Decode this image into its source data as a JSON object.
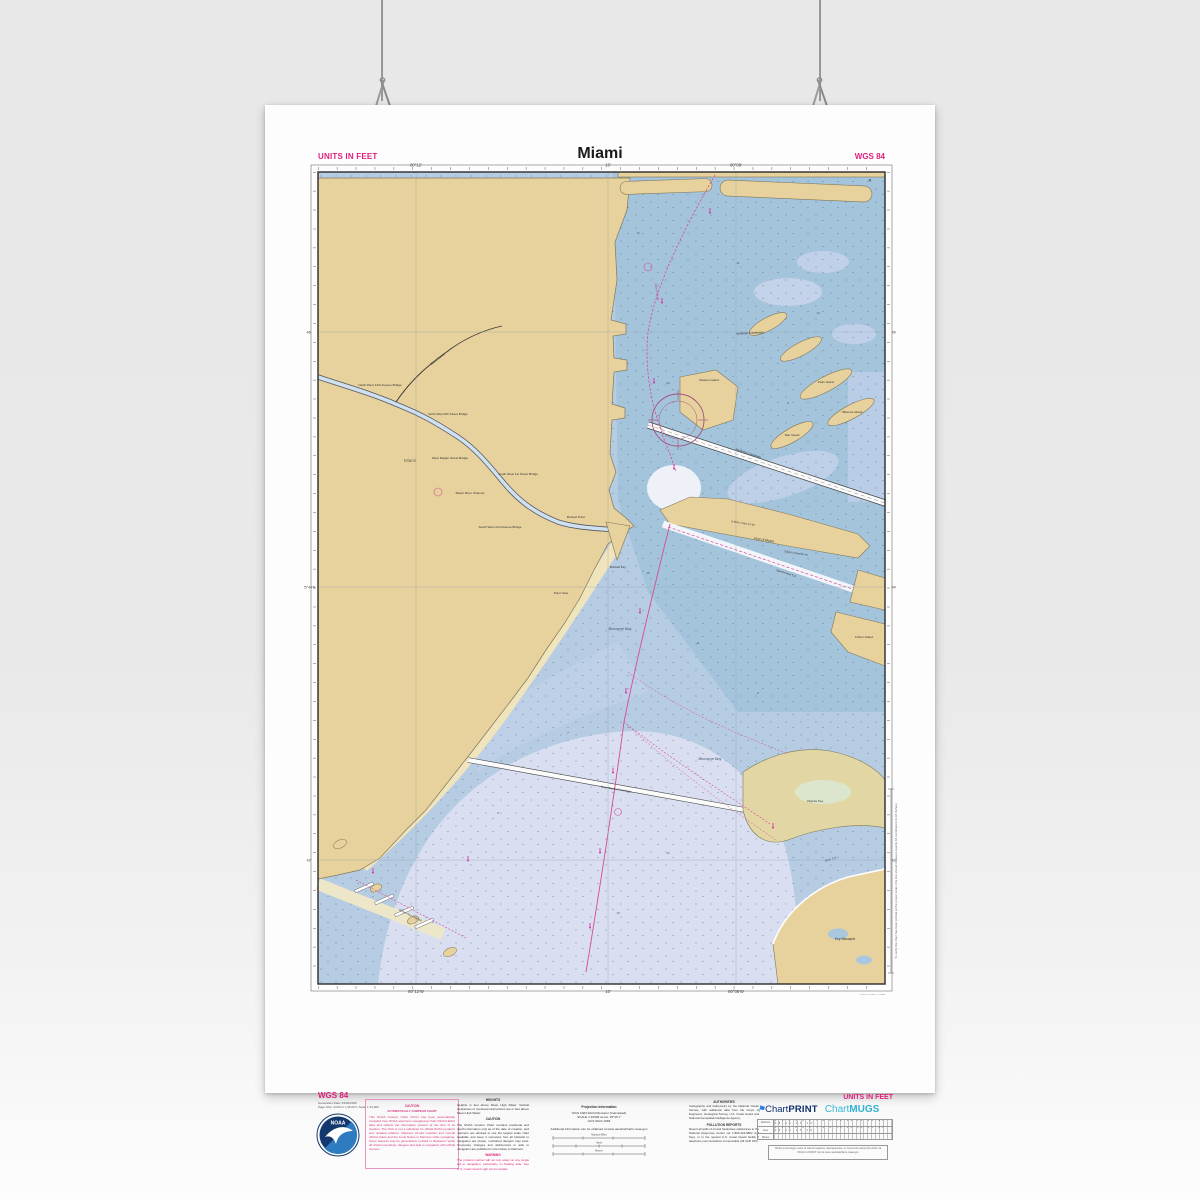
{
  "header": {
    "units": "UNITS IN FEET",
    "title": "Miami",
    "datum": "WGS 84"
  },
  "footer": {
    "left": {
      "datum": "WGS 84",
      "gen": "Generation Date: 03/04/2025",
      "size": "Page Size: 24.00 in x 36.00 in  Scale 1:15,000"
    },
    "caution_box": {
      "h": "CAUTION",
      "sub": "AUTOMATICALLY COMPILED CHART",
      "body": "This NOAA Custom Chart (NCC) has been automatically compiled from NOAA electronic navigational chart (NOAA ENC) data and reflects the information present at the time of its creation. The NCC is not a substitute for official NOAA products and updated editions. Mariners should maintain and consult official charts and the Local Notice to Mariners while navigating. Some features may be generalized, omitted or displaced. Verify all critical soundings, dangers and aids to navigation with official sources."
    },
    "notes": {
      "heights_h": "HEIGHTS",
      "heights": "Heights in feet above Mean High Water. Vertical clearances of overhead obstructions are in feet above Mean High Water.",
      "caution_h": "CAUTION",
      "caution": "The NOAA Custom Chart contains positional and depth information only as of the date of creation, and mariners are advised to use the largest scale chart available and keep it corrected. Not all hazards to navigation are shown; uncharted dangers may exist. Temporary changes and deficiencies in aids to navigation are published in the Notice to Mariners.",
      "warning_h": "WARNING",
      "warning": "The prudent mariner will not rely solely on any single aid to navigation, particularly on floating aids. See U.S. Coast Guard Light List for details."
    },
    "projection": {
      "h": "Projection information",
      "l1": "WGS 1984 World Mercator (Calculated)",
      "l2": "SCALE 1:15000 at Lat. 25°45.7'",
      "l3": "GCS WGS 1984",
      "info": "Additional information can be obtained at www.nauticalcharts.noaa.gov",
      "scale1": "Nautical Miles",
      "scale2": "Yards",
      "scale3": "Meters"
    },
    "authorities": {
      "h": "AUTHORITIES",
      "body": "Cartography and bathymetry by the National Ocean Service, with additional data from the Corps of Engineers, Geological Survey, U.S. Coast Guard and National Geospatial-Intelligence Agency.",
      "pollution_h": "POLLUTION REPORTS",
      "pollution": "Report all spills of oil and hazardous substances to the National Response Center via 1-800-424-8802 (toll free), or to the nearest U.S. Coast Guard facility if telephone communication is impossible (33 CFR 153)."
    },
    "brand": {
      "units": "UNITS IN FEET",
      "flag": "⚑",
      "cp1": "Chart",
      "cp2": "PRINT",
      "cm1": "Chart",
      "cm2": "MUGS",
      "row1": "Fathoms",
      "row2": "Feet",
      "row3": "Meters",
      "ticks1": "1 2 3 4 5 6 7 8 9 10 11 12 13 14 15 16 17 18",
      "ticks3": "",
      "disclaimer": "NOAA encourages users to submit inquiries, discrepancies, or comments about this chart via NOAA's ASSIST tool at www.nauticalcharts.noaa.gov"
    },
    "ruler_note": "To verify the chart has been printed at the proper scale, this line should measure exactly 10 centimeters (3.94 inches)",
    "credit": "NOAA ENC 11468"
  },
  "chart": {
    "grid": {
      "top1": "80°12'",
      "top2": "10'",
      "top3": "80°08'",
      "bot1": "80°12'W",
      "bot2": "10'",
      "bot3": "80°08'W",
      "left1": "46'",
      "left2": "25°44'N",
      "left3": "42'",
      "right1": "46'",
      "right2": "44'",
      "right3": "42'"
    },
    "labels": {
      "miami_city": "Miami",
      "miami_canal": "Miami Canal",
      "br1": "North West 12th Avenue Bridge",
      "br2": "North West 5th Street Bridge",
      "br3": "West Flagler Street Bridge",
      "br4": "South West 1st Street Bridge",
      "river_ch": "Miami River Channel",
      "br5": "South West 2nd Avenue Bridge",
      "brickell_pt": "Brickell Point",
      "brickell_key": "Brickell Key",
      "point_view": "Point View",
      "watson": "Watson Island",
      "palm": "Palm Island",
      "hibiscus": "Hibiscus Island",
      "star": "Star Island",
      "venetian": "Venetian Causeway",
      "macarthur": "MacArthur Causeway",
      "port": "Port of Miami",
      "berth1": "N Berth 2 Max 34'-36'",
      "berth2": "S Berth 3 Max 35'-40'",
      "gov_cut": "Government Cut",
      "fisher": "Fisher Island",
      "bay1": "Biscayne Bay",
      "bay2": "Biscayne Bay",
      "rickenbacker": "Rickenbacker Causeway",
      "virginia": "Virginia Key",
      "bear_cut": "Bear Cut",
      "key_biscayne": "Key Biscayne",
      "dinner": "Dinner Key Channel",
      "main_ch": "Main Channel",
      "wreck": "✕"
    },
    "depths": {
      "d1": "12",
      "d2": "11",
      "d3": "13",
      "d4": "10",
      "d5": "9",
      "d6": "16",
      "d7": "11",
      "d8": "8",
      "d9": "7",
      "d10": "9",
      "d11": "12",
      "d12": "10"
    },
    "colors": {
      "land": "#e7d19c",
      "water_deep": "#a4c4dc",
      "water_mid": "#b6cce3",
      "shoal": "#d9dff1",
      "magenta": "#d84a93"
    }
  }
}
